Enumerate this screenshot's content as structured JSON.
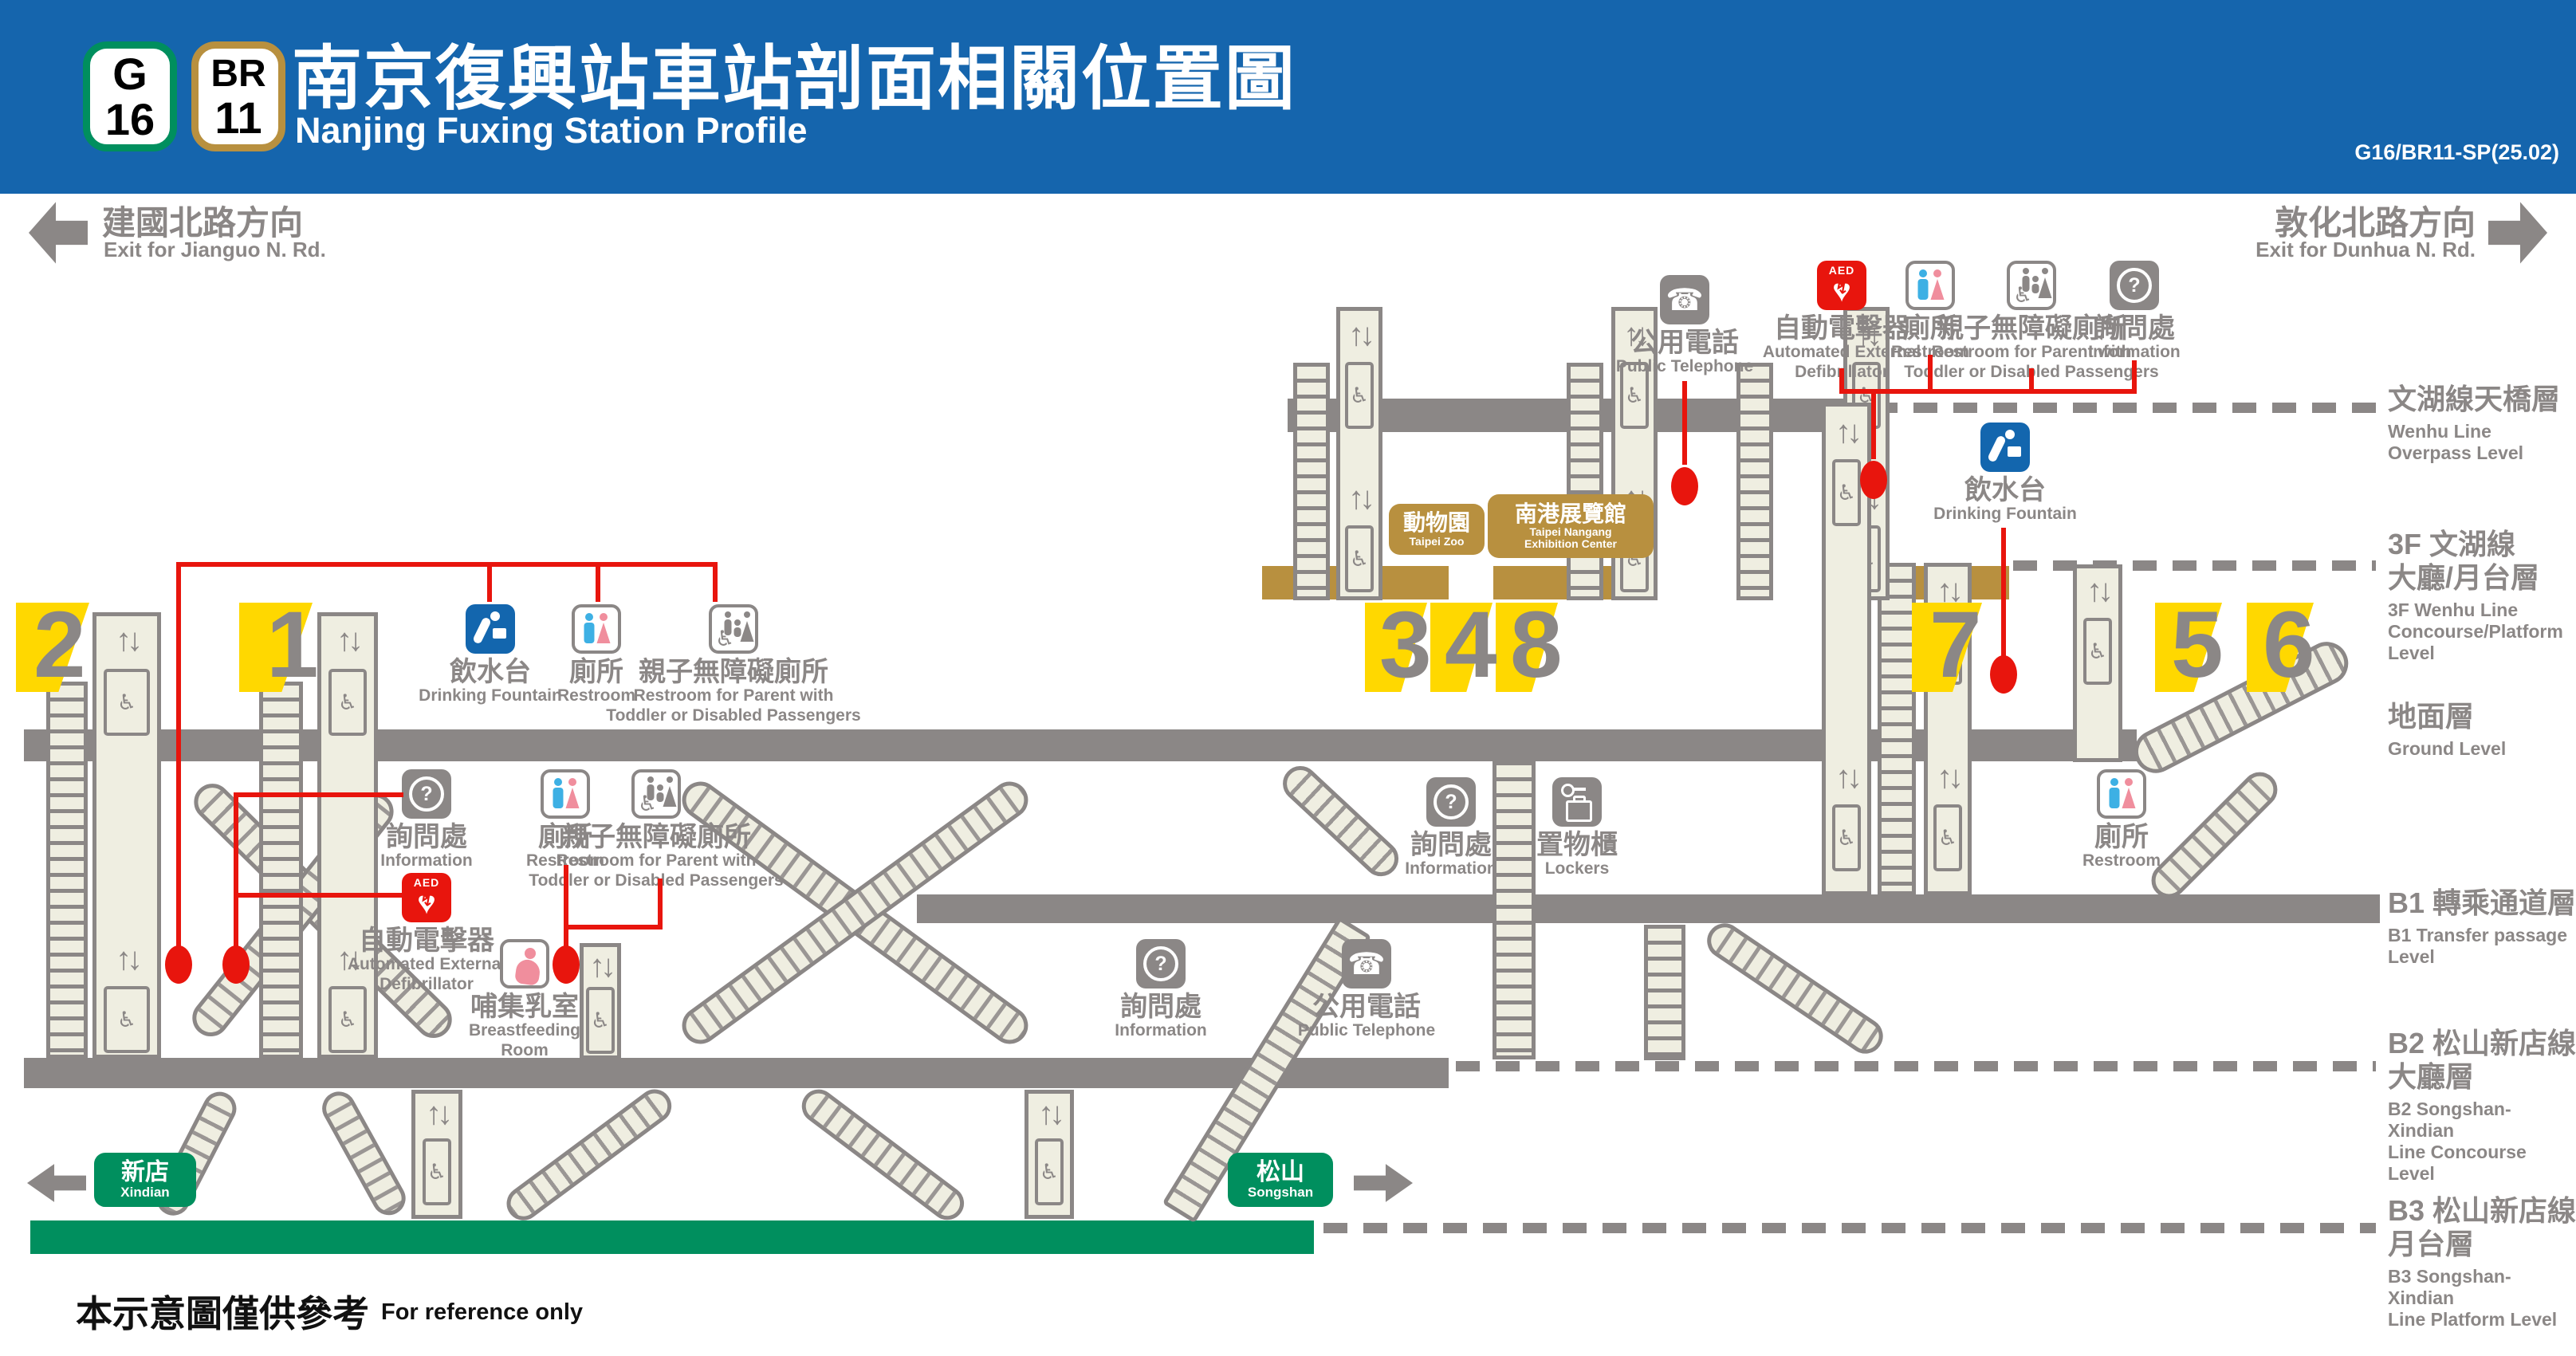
{
  "colors": {
    "header_bg": "#1565ad",
    "gray": "#8b8786",
    "beige": "#efeee1",
    "yellow": "#ffd800",
    "red": "#e8150d",
    "blue": "#1366ae",
    "brown": "#b8903f",
    "green": "#008f5e",
    "male_blue": "#3db0e4",
    "female_pink": "#f08e9d"
  },
  "header": {
    "badges": [
      {
        "letter": "G",
        "number": "16",
        "color": "#008f5e"
      },
      {
        "letter": "BR",
        "number": "11",
        "color": "#b8903f"
      }
    ],
    "title_zh": "南京復興站車站剖面相關位置圖",
    "title_en": "Nanjing Fuxing Station Profile",
    "code": "G16/BR11-SP(25.02)"
  },
  "directions": {
    "left": {
      "zh": "建國北路方向",
      "en": "Exit for Jianguo N. Rd."
    },
    "right": {
      "zh": "敦化北路方向",
      "en": "Exit for Dunhua N. Rd."
    }
  },
  "levels": [
    {
      "id": "overpass",
      "zh": [
        "文湖線天橋層"
      ],
      "en": [
        "Wenhu Line",
        "Overpass Level"
      ]
    },
    {
      "id": "3f",
      "zh": [
        "3F 文湖線",
        "大廳/月台層"
      ],
      "en": [
        "3F Wenhu Line",
        "Concourse/Platform",
        "Level"
      ]
    },
    {
      "id": "ground",
      "zh": [
        "地面層"
      ],
      "en": [
        "Ground Level"
      ]
    },
    {
      "id": "b1",
      "zh": [
        "B1 轉乘通道層"
      ],
      "en": [
        "B1 Transfer passage",
        "Level"
      ]
    },
    {
      "id": "b2",
      "zh": [
        "B2 松山新店線",
        "大廳層"
      ],
      "en": [
        "B2 Songshan-Xindian",
        "Line Concourse Level"
      ]
    },
    {
      "id": "b3",
      "zh": [
        "B3 松山新店線",
        "月台層"
      ],
      "en": [
        "B3 Songshan-Xindian",
        "Line Platform Level"
      ]
    }
  ],
  "exits": {
    "numbers": [
      "2",
      "1",
      "3",
      "4",
      "8",
      "7",
      "5",
      "6"
    ]
  },
  "facilities": {
    "phone": {
      "zh": "公用電話",
      "en": [
        "Public Telephone"
      ]
    },
    "aed": {
      "zh": "自動電擊器",
      "en": [
        "Automated External",
        "Defibrillator"
      ],
      "badge": "AED"
    },
    "restroom": {
      "zh": "廁所",
      "en": [
        "Restroom"
      ]
    },
    "family_restroom": {
      "zh": "親子無障礙廁所",
      "en": [
        "Restroom for Parent with",
        "Toddler or Disabled Passengers"
      ]
    },
    "info": {
      "zh": "詢問處",
      "en": [
        "Information"
      ]
    },
    "fountain": {
      "zh": "飲水台",
      "en": [
        "Drinking Fountain"
      ]
    },
    "lockers": {
      "zh": "置物櫃",
      "en": [
        "Lockers"
      ]
    },
    "breastfeeding": {
      "zh": "哺集乳室",
      "en": [
        "Breastfeeding",
        "Room"
      ]
    }
  },
  "destinations": {
    "taipei_zoo": {
      "zh": "動物園",
      "en": [
        "Taipei Zoo"
      ]
    },
    "nangang": {
      "zh": "南港展覽館",
      "en": [
        "Taipei Nangang",
        "Exhibition Center"
      ]
    },
    "xindian": {
      "zh": "新店",
      "en": [
        "Xindian"
      ]
    },
    "songshan": {
      "zh": "松山",
      "en": [
        "Songshan"
      ]
    }
  },
  "footer": {
    "zh": "本示意圖僅供參考",
    "en": "For reference only"
  }
}
